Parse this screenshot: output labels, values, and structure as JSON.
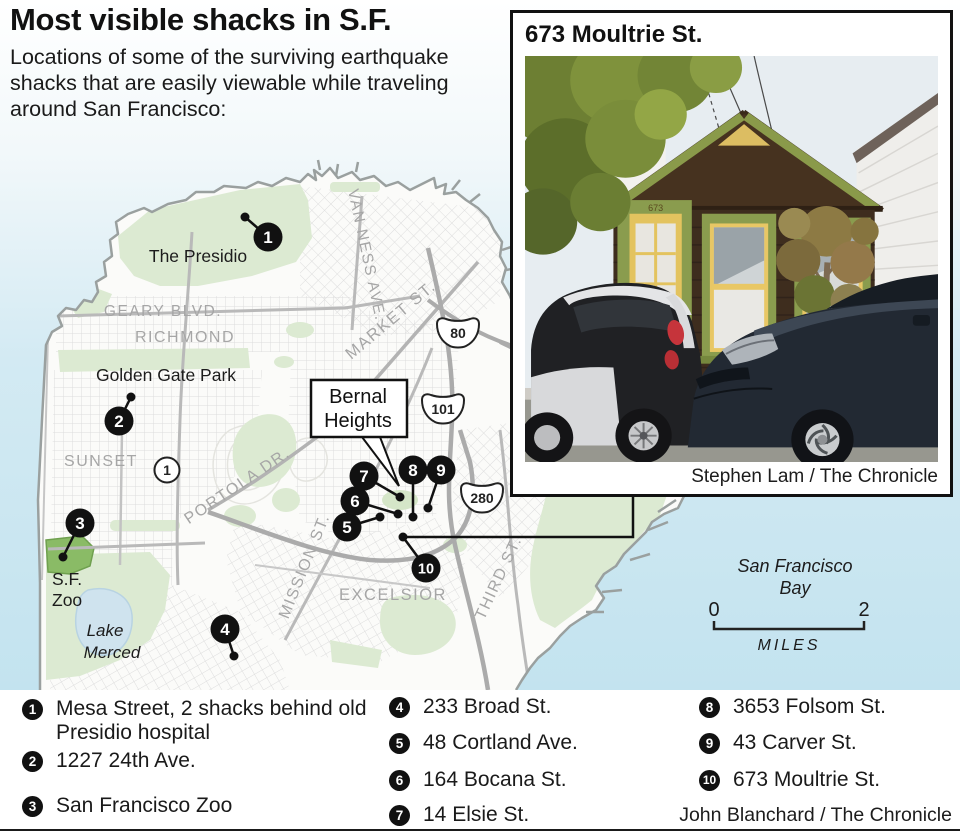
{
  "header": {
    "title": "Most visible shacks in S.F.",
    "subtitle": "Locations of some of the surviving earthquake shacks that are easily viewable while traveling around San Francisco:"
  },
  "photo": {
    "title": "673 Moultrie St.",
    "credit": "Stephen Lam / The Chronicle",
    "house_number": "673"
  },
  "map": {
    "labels": {
      "presidio": "The Presidio",
      "geary": "GEARY BLVD.",
      "richmond": "RICHMOND",
      "golden_gate_park": "Golden Gate Park",
      "sunset": "SUNSET",
      "portola": "PORTOLA DR.",
      "van_ness": "VAN NESS AVE.",
      "market": "MARKET ST.",
      "mission": "MISSION ST.",
      "excelsior": "EXCELSIOR",
      "third": "THIRD ST.",
      "sf_zoo_line1": "S.F.",
      "sf_zoo_line2": "Zoo",
      "lake_merced_line1": "Lake",
      "lake_merced_line2": "Merced",
      "bernal_line1": "Bernal",
      "bernal_line2": "Heights",
      "bay_line1": "San Francisco",
      "bay_line2": "Bay"
    },
    "shields": {
      "i80": "80",
      "us101": "101",
      "i280": "280",
      "ca1": "1"
    },
    "scale": {
      "start": "0",
      "end": "2",
      "unit": "MILES"
    },
    "markers": [
      "1",
      "2",
      "3",
      "4",
      "5",
      "6",
      "7",
      "8",
      "9",
      "10"
    ]
  },
  "legend": {
    "items": [
      {
        "num": "1",
        "label": "Mesa Street, 2 shacks behind old Presidio hospital"
      },
      {
        "num": "2",
        "label": "1227 24th Ave."
      },
      {
        "num": "3",
        "label": "San Francisco Zoo"
      },
      {
        "num": "4",
        "label": "233 Broad St."
      },
      {
        "num": "5",
        "label": "48 Cortland Ave."
      },
      {
        "num": "6",
        "label": "164 Bocana St."
      },
      {
        "num": "7",
        "label": "14 Elsie St."
      },
      {
        "num": "8",
        "label": "3653 Folsom St."
      },
      {
        "num": "9",
        "label": "43 Carver St."
      },
      {
        "num": "10",
        "label": "673 Moultrie St."
      }
    ],
    "credit": "John Blanchard / The Chronicle"
  },
  "colors": {
    "ocean": "#c9e6f1",
    "park": "#dcead2",
    "zoo_green": "#8abb66",
    "road": "#b9b9b9",
    "marker": "#111111"
  }
}
